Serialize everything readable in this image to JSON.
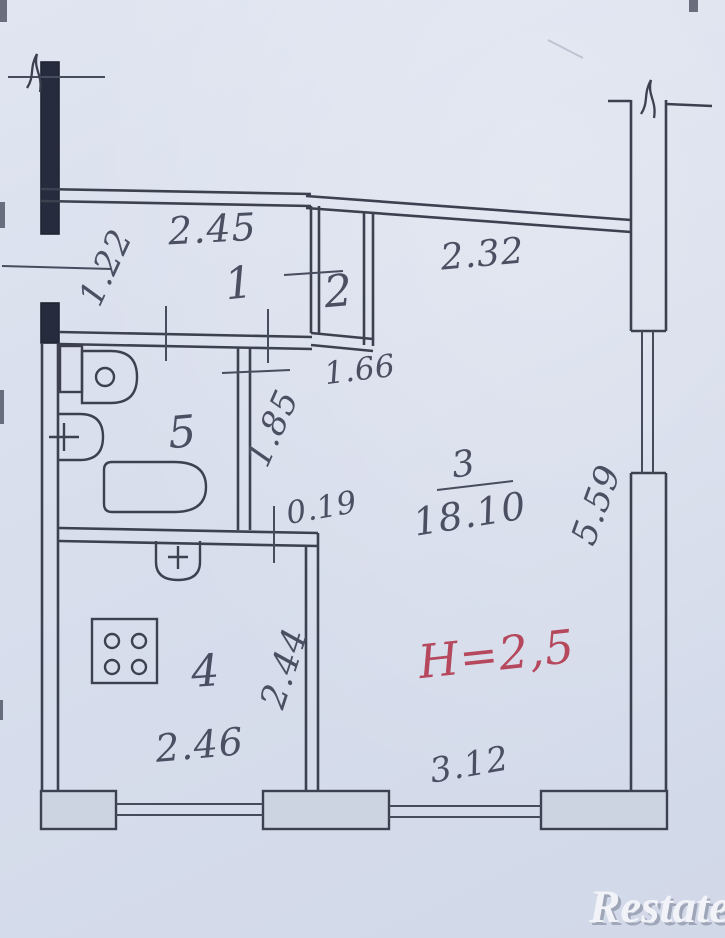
{
  "plan": {
    "rooms": {
      "hall": {
        "number": "1"
      },
      "closet": {
        "number": "2"
      },
      "living": {
        "number": "3",
        "area": "18.10"
      },
      "kitchen": {
        "number": "4"
      },
      "bath": {
        "number": "5"
      }
    },
    "dimensions": {
      "hall_width": "2.45",
      "entry_side": "1.22",
      "living_top": "2.32",
      "closet_bottom": "1.66",
      "corridor_length": "1.85",
      "wall_step": "0.19",
      "living_right": "5.59",
      "kitchen_right": "2.44",
      "kitchen_bottom": "2.46",
      "living_bottom": "3.12"
    },
    "ceiling_height": "H=2,5"
  },
  "watermark": {
    "text": "Restate"
  },
  "colors": {
    "paper": "#d8deec",
    "ink": "#3c4150",
    "pencil": "#4a4f61",
    "wall_fill": "#ccd3e1",
    "solid_wall": "#262b3d",
    "height_red": "#b5485c",
    "watermark_white": "#f1f3f8"
  }
}
